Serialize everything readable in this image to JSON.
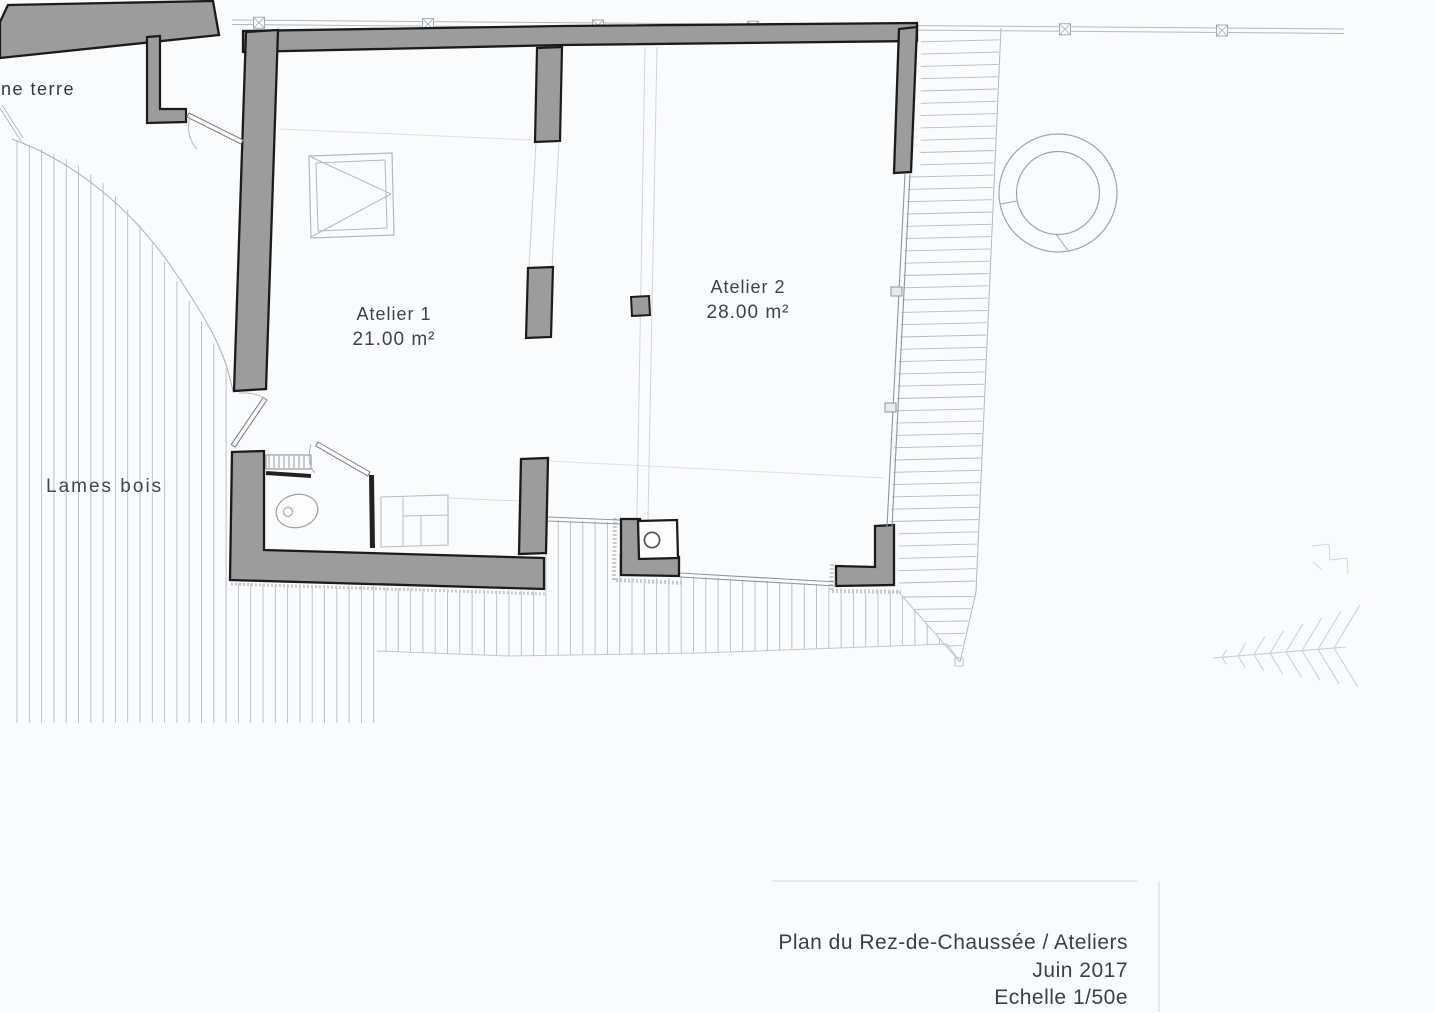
{
  "plan": {
    "labels": {
      "site_left": "ne terre",
      "ground": "Lames bois"
    },
    "rooms": [
      {
        "name": "Atelier 1",
        "area": "21.00 m²"
      },
      {
        "name": "Atelier 2",
        "area": "28.00 m²"
      }
    ],
    "title_block": {
      "title": "Plan du Rez-de-Chaussée / Ateliers",
      "date": "Juin 2017",
      "scale": "Echelle 1/50e"
    },
    "colors": {
      "background": "#fafbfc",
      "wall_fill": "#9c9c9c",
      "wall_outline": "#1b1b1b",
      "hatch_line": "#b7bbbf",
      "thin_line": "#9aa0a5",
      "faint_line": "#c9cdd0",
      "text": "#3f4347"
    }
  }
}
